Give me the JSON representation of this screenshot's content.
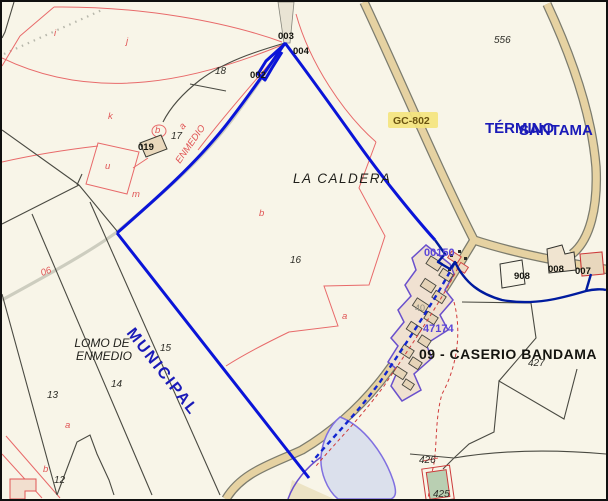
{
  "labels": {
    "la_caldera": "LA CALDERA",
    "lomo_line1": "LOMO DE",
    "lomo_line2": "ENMEDIO",
    "municipal": "MUNICIPAL",
    "termino": "TÉRMINO",
    "santa": "SANTAMA",
    "caserio": "09 - CASERIO BANDAMA",
    "gc802": "GC-802",
    "camino_enmedio": "ENMEDIO",
    "road_06": "06"
  },
  "numbers": {
    "n556": "556",
    "n18": "18",
    "n17": "17",
    "n16": "16",
    "n15": "15",
    "n14": "14",
    "n13": "13",
    "n12": "12",
    "n427": "427",
    "n426": "426",
    "n425": "425",
    "n908": "908",
    "n008": "008",
    "n007": "007",
    "n002": "002",
    "n003": "003",
    "n004": "004",
    "n019": "019",
    "n40": "40",
    "v00150": "00150",
    "v47174": "47174"
  },
  "letters": {
    "i": "i",
    "j": "j",
    "k": "k",
    "u": "u",
    "m": "m",
    "a": "a",
    "b": "b"
  },
  "colors": {
    "background": "#f8f5e8",
    "parcel_line_red": "#e86a6a",
    "parcel_line_black": "#4a4a42",
    "boundary_blue": "#0a14d8",
    "boundary_navy": "#001b9e",
    "settlement_violet": "#6a50cc",
    "road_fill": "#e6d2a2",
    "road_casing": "#7c7c6e",
    "water_fill": "#dbe0ec",
    "settlement_fill": "#f0e1d1",
    "building_fill": "#e6d4b8",
    "label_highlight_yellow": "#f4e47e",
    "blue_text": "#1a1ab8",
    "green_parcel": "#b9cfb2"
  }
}
